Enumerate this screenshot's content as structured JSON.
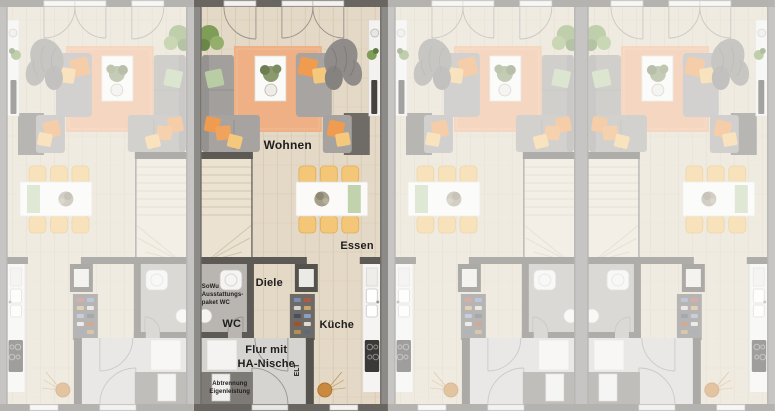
{
  "image": {
    "type": "architectural floor plan rendering (top view)",
    "subject": "Row of four townhouse ground-floor plans; second unit from the left is highlighted in full colour, the other three are dimmed"
  },
  "units": [
    {
      "name": "unit-1",
      "state": "dimmed",
      "orientation": "mirrored"
    },
    {
      "name": "unit-2",
      "state": "highlighted",
      "orientation": "standard"
    },
    {
      "name": "unit-3",
      "state": "dimmed",
      "orientation": "mirrored"
    },
    {
      "name": "unit-4",
      "state": "dimmed",
      "orientation": "standard"
    }
  ],
  "labels": {
    "wohnen": "Wohnen",
    "essen": "Essen",
    "diele": "Diele",
    "wc": "WC",
    "kueche": "Küche",
    "flur": "Flur mit\nHA-Nische",
    "elt": "ELT",
    "sowu_note": "SoWu\nAusstattungs-\npaket WC",
    "abtrennung_note": "Abtrennung\nEigenleistung"
  },
  "colors": {
    "party_wall": "#8d8b88",
    "interior_wall": "#5d5955",
    "top_wall": "#696561",
    "floor_wood": "#e4d9c6",
    "floor_hall": "#d6d4d1",
    "floor_wc": "#b9b5b0",
    "rug_orange": "#eeb084",
    "pillow_orange": "#ef9b50",
    "pillow_yellow": "#f4c97e",
    "pillow_green": "#b9cda4",
    "chair_yellow": "#f3c678",
    "bench_green": "#c0d3ac",
    "sofa_gray": "#a29f9c",
    "plant_green": "#7e9d57",
    "label_text": "#1d1d1d",
    "dim_overlay": "rgba(252,251,249,0.52)"
  }
}
